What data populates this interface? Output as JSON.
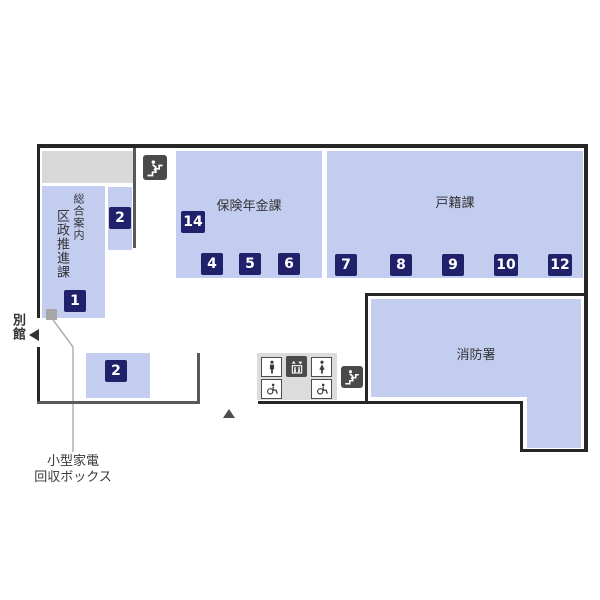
{
  "rooms": {
    "kusei_suishin": {
      "name_main": "区政推進課",
      "name_sub": "総合案内",
      "badge": "1"
    },
    "counter_upper": {
      "badge": "2"
    },
    "counter_lower": {
      "badge": "2"
    },
    "hoken_nenkin": {
      "name": "保険年金課",
      "badge_side": "14",
      "badges": [
        "4",
        "5",
        "6"
      ]
    },
    "koseki": {
      "name": "戸籍課",
      "badges": [
        "7",
        "8",
        "9",
        "10",
        "12"
      ]
    },
    "shobosho": {
      "name": "消防署"
    }
  },
  "labels": {
    "annex": "別館",
    "collection_box": {
      "line1": "小型家電",
      "line2": "回収ボックス"
    }
  },
  "icons": {
    "stairs_upper": "stairs-icon",
    "stairs_lower": "stairs-icon",
    "male": "male-restroom-icon",
    "elevator": "elevator-icon",
    "female": "female-restroom-icon",
    "accessible_left": "accessible-restroom-icon",
    "accessible_right": "accessible-restroom-icon",
    "annex_arrow": "left-arrow-icon",
    "entrance": "entrance-triangle-icon",
    "collection_marker": "collection-box-marker"
  },
  "colors": {
    "room_fill": "#c3cdf0",
    "badge_bg": "#21216b",
    "badge_text": "#ffffff",
    "outer_wall": "#262626",
    "partition": "#595959",
    "gray_block": "#d9d9d9",
    "facility_block": "#dcdcdc",
    "icon_dark": "#4a4a4a",
    "text": "#333333"
  }
}
